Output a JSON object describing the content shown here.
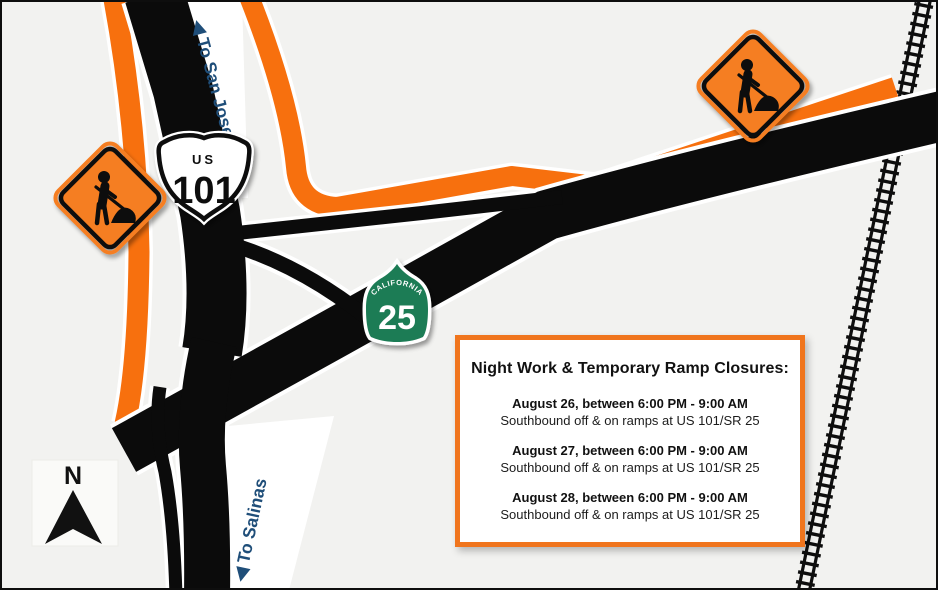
{
  "map": {
    "background_color": "#F2F2F0",
    "road_color": "#0B0B0B",
    "closure_highlight_color": "#F7700E",
    "sign_orange_color": "#F57E20",
    "direction_label_color": "#1F4E79",
    "shield_green_color": "#1E7B55",
    "infobox_border_color": "#F0751D"
  },
  "shields": {
    "us_101": {
      "banner": "US",
      "number": "101"
    },
    "ca_25": {
      "state": "CALIFORNIA",
      "number": "25"
    }
  },
  "direction_labels": {
    "san_jose": {
      "arrow": "◀",
      "text": " To San Jose"
    },
    "salinas": {
      "arrow": "◀",
      "text": " To Salinas"
    }
  },
  "compass": {
    "label": "N"
  },
  "infobox": {
    "title": "Night Work & Temporary Ramp Closures:",
    "closures": [
      {
        "date": "August 26, between 6:00 PM - 9:00 AM",
        "detail": "Southbound off & on ramps at US 101/SR 25"
      },
      {
        "date": "August 27, between 6:00 PM - 9:00 AM",
        "detail": "Southbound off & on ramps at US 101/SR 25"
      },
      {
        "date": "August 28, between 6:00 PM - 9:00 AM",
        "detail": "Southbound off & on ramps at US 101/SR 25"
      }
    ]
  }
}
